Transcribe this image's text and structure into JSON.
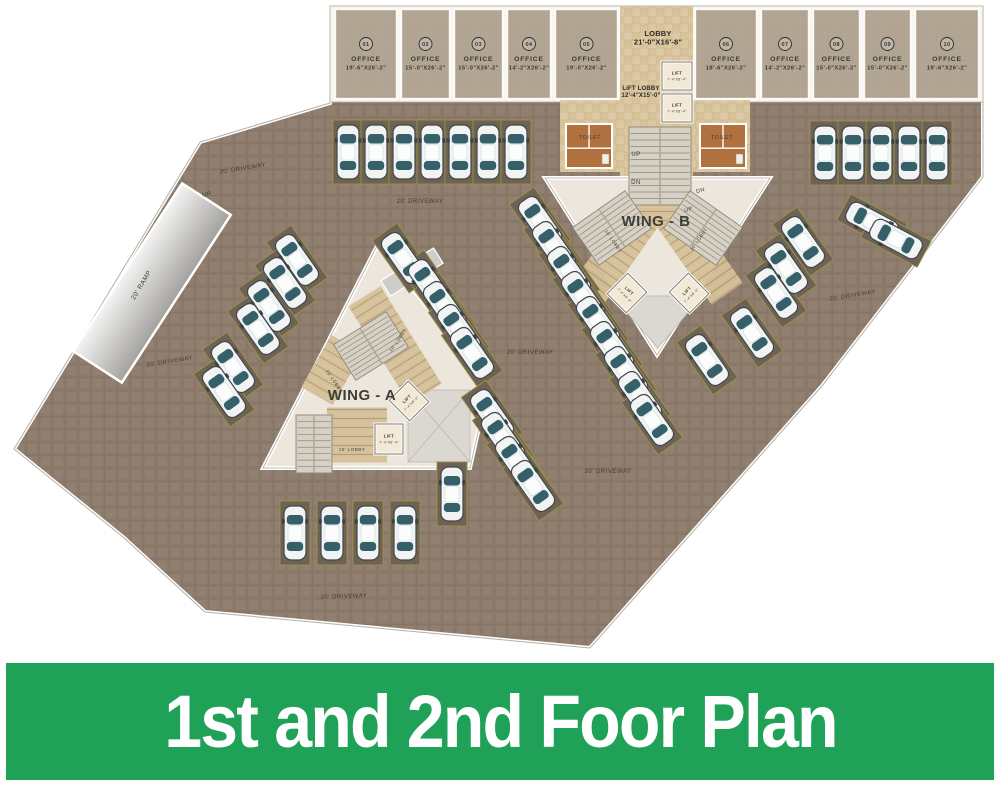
{
  "banner": {
    "title": "1st and 2nd Foor Plan",
    "bg": "#1fa257",
    "text_color": "#ffffff"
  },
  "plan": {
    "colors": {
      "plate": "#8c7b6b",
      "bay": "#6e6254",
      "bay_border": "#9b9246",
      "office": "#b2a593",
      "marble": "#d7c29a",
      "wing": "#ece6dc",
      "paving": "#d4bf97",
      "stair": "#d7d0c4",
      "gray_zone": "#dbd7d1",
      "toilet": "#b0713f",
      "car_glass": "#356069",
      "wall": "#ffffff"
    },
    "outline": [
      [
        330,
        6
      ],
      [
        983,
        6
      ],
      [
        983,
        177
      ],
      [
        822,
        386
      ],
      [
        590,
        648
      ],
      [
        205,
        612
      ],
      [
        123,
        537
      ],
      [
        14,
        449
      ],
      [
        200,
        142
      ],
      [
        330,
        103
      ]
    ],
    "offices": [
      {
        "num": "01",
        "label": "OFFICE",
        "dims": "19'-6\"X26'-2\"",
        "x1": 333,
        "x2": 399
      },
      {
        "num": "02",
        "label": "OFFICE",
        "dims": "15'-0\"X26'-2\"",
        "x1": 399,
        "x2": 452
      },
      {
        "num": "03",
        "label": "OFFICE",
        "dims": "15'-0\"X26'-2\"",
        "x1": 452,
        "x2": 505
      },
      {
        "num": "04",
        "label": "OFFICE",
        "dims": "14'-2\"X26'-2\"",
        "x1": 505,
        "x2": 553
      },
      {
        "num": "05",
        "label": "OFFICE",
        "dims": "19'-0\"X26'-2\"",
        "x1": 553,
        "x2": 620
      },
      {
        "num": "06",
        "label": "OFFICE",
        "dims": "18'-6\"X26'-2\"",
        "x1": 693,
        "x2": 759
      },
      {
        "num": "07",
        "label": "OFFICE",
        "dims": "14'-2\"X26'-2\"",
        "x1": 759,
        "x2": 811
      },
      {
        "num": "08",
        "label": "OFFICE",
        "dims": "15'-0\"X26'-2\"",
        "x1": 811,
        "x2": 862
      },
      {
        "num": "09",
        "label": "OFFICE",
        "dims": "15'-0\"X26'-2\"",
        "x1": 862,
        "x2": 913
      },
      {
        "num": "10",
        "label": "OFFICE",
        "dims": "19'-6\"X26'-2\"",
        "x1": 913,
        "x2": 981
      }
    ],
    "wings": {
      "a_poly": [
        [
          377,
          246
        ],
        [
          448,
          332
        ],
        [
          487,
          392
        ],
        [
          470,
          468
        ],
        [
          263,
          468
        ]
      ],
      "b_poly": [
        [
          545,
          178
        ],
        [
          770,
          178
        ],
        [
          657,
          355
        ]
      ]
    },
    "multiline_labels": [
      {
        "n": "lobby-label",
        "lines": [
          "LOBBY",
          "21'-0\"X16'-8\""
        ],
        "x": 658,
        "y": 36,
        "s": 7.5,
        "w": 700,
        "lh": 8.5
      },
      {
        "n": "lift-lobby-label",
        "lines": [
          "LIFT LOBBY",
          "12'-4\"X15'-0\""
        ],
        "x": 641,
        "y": 90,
        "s": 6,
        "w": 700,
        "lh": 7
      }
    ],
    "labels": [
      {
        "n": "driveway-label",
        "t": "20' DRIVEWAY",
        "x": 243,
        "y": 170,
        "r": -9,
        "s": 6
      },
      {
        "n": "driveway-label",
        "t": "20' DRIVEWAY",
        "x": 420,
        "y": 203,
        "r": 0,
        "s": 6
      },
      {
        "n": "driveway-label",
        "t": "20' DRIVEWAY",
        "x": 170,
        "y": 363,
        "r": -9,
        "s": 6
      },
      {
        "n": "driveway-label",
        "t": "20' DRIVEWAY",
        "x": 530,
        "y": 354,
        "r": 0,
        "s": 6
      },
      {
        "n": "driveway-label",
        "t": "20' DRIVEWAY",
        "x": 608,
        "y": 473,
        "r": 0,
        "s": 6
      },
      {
        "n": "driveway-label",
        "t": "20' DRIVEWAY",
        "x": 344,
        "y": 598,
        "r": -2,
        "s": 6
      },
      {
        "n": "driveway-label",
        "t": "20' DRIVEWAY",
        "x": 853,
        "y": 297,
        "r": -9,
        "s": 6
      },
      {
        "n": "ramp-up-label",
        "t": "UP",
        "x": 207,
        "y": 196,
        "r": -9,
        "s": 6
      },
      {
        "n": "ramp-label",
        "t": "20' RAMP",
        "x": 143,
        "y": 286,
        "r": -59,
        "s": 6.5
      },
      {
        "n": "stairs-up-label",
        "t": "UP",
        "x": 636,
        "y": 156,
        "r": 0,
        "s": 6
      },
      {
        "n": "stairs-dn-label",
        "t": "DN",
        "x": 636,
        "y": 184,
        "r": 0,
        "s": 6
      },
      {
        "n": "stairs-dn-label",
        "t": "DN",
        "x": 701,
        "y": 192,
        "r": -18,
        "s": 5.5
      },
      {
        "n": "stairs-up-label",
        "t": "UP",
        "x": 689,
        "y": 211,
        "r": -18,
        "s": 5.5
      },
      {
        "n": "wing-a-label",
        "t": "WING - A",
        "x": 362,
        "y": 400,
        "r": 0,
        "s": 15,
        "w": 700
      },
      {
        "n": "wing-b-label",
        "t": "WING - B",
        "x": 656,
        "y": 226,
        "r": 0,
        "s": 15,
        "w": 700
      },
      {
        "n": "toilet-label",
        "t": "TOILET",
        "x": 590,
        "y": 139,
        "r": 0,
        "s": 5.5
      },
      {
        "n": "toilet-label",
        "t": "TOILET",
        "x": 722,
        "y": 139,
        "r": 0,
        "s": 5.5
      },
      {
        "n": "lobby10-label",
        "t": "10' LOBBY",
        "x": 399,
        "y": 341,
        "r": -55,
        "s": 4.5
      },
      {
        "n": "lobby10-label",
        "t": "10' LOBBY",
        "x": 333,
        "y": 382,
        "r": 55,
        "s": 4.5
      },
      {
        "n": "lobby10-label",
        "t": "10' LOBBY",
        "x": 352,
        "y": 451,
        "r": 0,
        "s": 4.5
      },
      {
        "n": "lobby10-label",
        "t": "10' LOBBY",
        "x": 612,
        "y": 242,
        "r": 55,
        "s": 4.5
      },
      {
        "n": "lobby10-label",
        "t": "10' LOBBY",
        "x": 700,
        "y": 240,
        "r": -55,
        "s": 4.5
      }
    ],
    "lifts": [
      {
        "label": "LIFT",
        "dims": "7'-4\"X8'-4\"",
        "x": 677,
        "y": 76,
        "r": 0,
        "w": 30,
        "h": 28
      },
      {
        "label": "LIFT",
        "dims": "7'-4\"X8'-4\"",
        "x": 677,
        "y": 108,
        "r": 0,
        "w": 30,
        "h": 28
      },
      {
        "label": "LIFT",
        "dims": "7'-4\"X8'-4\"",
        "x": 409,
        "y": 401,
        "r": -45,
        "w": 27,
        "h": 29
      },
      {
        "label": "LIFT",
        "dims": "7'-4\"X8'-4\"",
        "x": 389,
        "y": 439,
        "r": 0,
        "w": 28,
        "h": 30
      },
      {
        "label": "LIFT",
        "dims": "7'-4\"X8'-4\"",
        "x": 627,
        "y": 293,
        "r": 45,
        "w": 27,
        "h": 29
      },
      {
        "label": "LIFT",
        "dims": "7'-4\"X8'-4\"",
        "x": 689,
        "y": 293,
        "r": -45,
        "w": 27,
        "h": 29
      }
    ],
    "toilets": [
      {
        "x": 566,
        "y": 124,
        "w": 46,
        "h": 44
      },
      {
        "x": 700,
        "y": 124,
        "w": 46,
        "h": 44
      }
    ],
    "stairs": [
      {
        "x": 660,
        "y": 166,
        "w": 62,
        "h": 78,
        "r": 0,
        "n": 11
      },
      {
        "x": 612,
        "y": 228,
        "w": 64,
        "h": 46,
        "r": -35,
        "n": 8
      },
      {
        "x": 703,
        "y": 228,
        "w": 64,
        "h": 46,
        "r": 35,
        "n": 8
      },
      {
        "x": 371,
        "y": 346,
        "w": 62,
        "h": 42,
        "r": -32,
        "n": 8
      },
      {
        "x": 314,
        "y": 444,
        "w": 36,
        "h": 58,
        "r": 0,
        "n": 8
      }
    ],
    "paving": [
      {
        "x": 657,
        "y": 200,
        "w": 44,
        "h": 48,
        "r": 0
      },
      {
        "x": 615,
        "y": 255,
        "w": 38,
        "h": 95,
        "r": 35
      },
      {
        "x": 700,
        "y": 255,
        "w": 38,
        "h": 95,
        "r": -35
      },
      {
        "x": 357,
        "y": 435,
        "w": 60,
        "h": 55,
        "r": 0
      },
      {
        "x": 395,
        "y": 345,
        "w": 38,
        "h": 115,
        "r": -32
      },
      {
        "x": 332,
        "y": 370,
        "w": 36,
        "h": 60,
        "r": 30
      }
    ],
    "gray_zones": {
      "wing_a_rect": {
        "x": 408,
        "y": 390,
        "w": 62,
        "h": 72
      },
      "wing_b_tri": [
        [
          612,
          296
        ],
        [
          702,
          296
        ],
        [
          658,
          348
        ]
      ],
      "apex_strip": {
        "x": 412,
        "y": 272,
        "w": 62,
        "h": 18,
        "r": -32
      }
    },
    "ramp": {
      "x": 123,
      "y": 183,
      "w": 58,
      "h": 200,
      "r": 33,
      "cx": 152,
      "cy": 283
    },
    "cars": [
      {
        "x": 348,
        "y": 152,
        "r": 0
      },
      {
        "x": 376,
        "y": 152,
        "r": 0
      },
      {
        "x": 404,
        "y": 152,
        "r": 0
      },
      {
        "x": 432,
        "y": 152,
        "r": 0
      },
      {
        "x": 460,
        "y": 152,
        "r": 0
      },
      {
        "x": 488,
        "y": 152,
        "r": 0
      },
      {
        "x": 516,
        "y": 152,
        "r": 0
      },
      {
        "x": 825,
        "y": 153,
        "r": 0
      },
      {
        "x": 853,
        "y": 153,
        "r": 0
      },
      {
        "x": 881,
        "y": 153,
        "r": 0
      },
      {
        "x": 909,
        "y": 153,
        "r": 0
      },
      {
        "x": 937,
        "y": 153,
        "r": 0
      },
      {
        "x": 297,
        "y": 260,
        "r": -35
      },
      {
        "x": 285,
        "y": 283,
        "r": -35
      },
      {
        "x": 269,
        "y": 306,
        "r": -35
      },
      {
        "x": 258,
        "y": 329,
        "r": -35
      },
      {
        "x": 233,
        "y": 367,
        "r": -35
      },
      {
        "x": 224,
        "y": 392,
        "r": -35
      },
      {
        "x": 403,
        "y": 258,
        "r": -35
      },
      {
        "x": 430,
        "y": 285,
        "r": -35
      },
      {
        "x": 445,
        "y": 307,
        "r": -35
      },
      {
        "x": 459,
        "y": 330,
        "r": -35
      },
      {
        "x": 472,
        "y": 353,
        "r": -35
      },
      {
        "x": 492,
        "y": 415,
        "r": -35
      },
      {
        "x": 503,
        "y": 438,
        "r": -35
      },
      {
        "x": 517,
        "y": 462,
        "r": -35
      },
      {
        "x": 533,
        "y": 486,
        "r": -35
      },
      {
        "x": 540,
        "y": 222,
        "r": -35
      },
      {
        "x": 554,
        "y": 247,
        "r": -35
      },
      {
        "x": 569,
        "y": 272,
        "r": -35
      },
      {
        "x": 583,
        "y": 297,
        "r": -35
      },
      {
        "x": 598,
        "y": 322,
        "r": -35
      },
      {
        "x": 612,
        "y": 347,
        "r": -35
      },
      {
        "x": 626,
        "y": 372,
        "r": -35
      },
      {
        "x": 640,
        "y": 397,
        "r": -35
      },
      {
        "x": 652,
        "y": 420,
        "r": -35
      },
      {
        "x": 803,
        "y": 242,
        "r": -35
      },
      {
        "x": 786,
        "y": 268,
        "r": -35
      },
      {
        "x": 776,
        "y": 293,
        "r": -35
      },
      {
        "x": 752,
        "y": 333,
        "r": -35
      },
      {
        "x": 707,
        "y": 360,
        "r": -35
      },
      {
        "x": 872,
        "y": 222,
        "r": -62
      },
      {
        "x": 896,
        "y": 239,
        "r": -62
      },
      {
        "x": 295,
        "y": 533,
        "r": 0
      },
      {
        "x": 332,
        "y": 533,
        "r": 0
      },
      {
        "x": 368,
        "y": 533,
        "r": 0
      },
      {
        "x": 405,
        "y": 533,
        "r": 0
      },
      {
        "x": 452,
        "y": 494,
        "r": 0
      }
    ]
  }
}
